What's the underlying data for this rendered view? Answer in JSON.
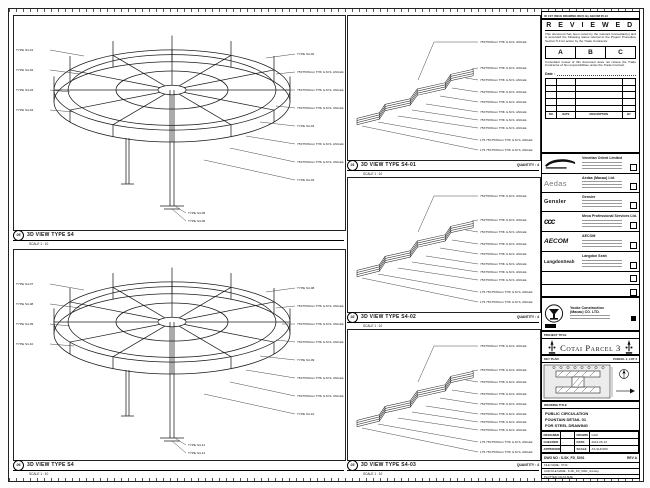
{
  "sheet": {
    "revision_strip": "00 1ST ISSUE DRAWING REV1 By AECOM 05.13",
    "stamp": {
      "title": "R E V I E W E D",
      "body1": "This document has been noted by the relevant Consultant(s) and is accorded the following status referral to the Project Procedure Section 5.4 for action by the Trade Contractor.",
      "grade_a": "A",
      "grade_b": "B",
      "grade_c": "C",
      "body2": "Consultant review of this document does not relieve the Trade Contractor of his responsibilities under the Trade Contract.",
      "date_label": "Date :",
      "th_no": "NO.",
      "th_date": "DATE",
      "th_desc": "DESCRIPTION",
      "th_by": "BY"
    },
    "consultants": {
      "venetian": "Venetian Orient Limited",
      "aedas_logo": "Aedas",
      "aedas": "Aedas (Macau) Ltd.",
      "gensler_logo": "Gensler",
      "gensler": "Gensler",
      "meca_logo": "ccc",
      "meca": "Meca Professional Services Ltd.",
      "aecom_logo": "AECOM",
      "aecom": "AECOM",
      "langdon_logo": "LangdonSeah",
      "langdon": "Langdon Seah"
    },
    "contractor": {
      "name1": "Yooke Construction",
      "name2": "(Macau) CO. LTD."
    },
    "project": {
      "band_label": "PROJECT TITLE",
      "title": "Cotai Parcel 3"
    },
    "key_plan": {
      "band_label": "KEY PLAN",
      "zone_label": "PARCEL 1, LOT 3"
    },
    "drawing_title": {
      "band_label": "DRAWING TITLE",
      "line1": "PUBLIC CIRCULATION",
      "line2": "FOUNTAIN DETAIL 01",
      "line3": "FOR STEEL DRAWING"
    },
    "info": {
      "designed_label": "DESIGNED",
      "designed": "-",
      "drawn_label": "DRAWN",
      "drawn": "CAD",
      "checked_label": "CHECKED",
      "checked": "-",
      "date_label": "DATE",
      "date": "2013-05-13",
      "approved_label": "APPROVED",
      "approved": "-",
      "scale_label": "SCALE",
      "scale": "AS SHOWN",
      "dwg_label": "DWG NO : S-SK_FD_S001",
      "rev_label": "REV  A",
      "file_name": "FILE NAME : 0710",
      "cad_file": "CAD FILE NAME : S-SK_FD_S001_S4.dwg",
      "plotted": "PLOTTED ON A3 SIZE"
    }
  },
  "panels": {
    "a": {
      "bubble": "05",
      "title": "3D VIEW TYPE S4",
      "scale": "SCALE 1 : 10",
      "left_labels": [
        "TYPE S4-01",
        "TYPE S4-02",
        "TYPE S4-03",
        "TYPE S4-04"
      ],
      "right_labels": [
        "TYPE S4-02",
        "75X75X6mm THK G.M.S. ANGLE",
        "75X75X6mm THK G.M.S. ANGLE",
        "75X75X6mm THK G.M.S. ANGLE",
        "TYPE S4-03",
        "75X75X6mm THK G.M.S. ANGLE",
        "75X75X6mm THK G.M.S. ANGLE",
        "TYPE S4-04"
      ],
      "bottom_labels": [
        "TYPE S4-05",
        "TYPE S4-06"
      ]
    },
    "b": {
      "bubble": "06",
      "title": "3D VIEW TYPE S4",
      "scale": "SCALE 1 : 10",
      "left_labels": [
        "TYPE S4-07",
        "TYPE S4-08",
        "TYPE S4-09",
        "TYPE S4-10"
      ],
      "right_labels": [
        "TYPE S4-08",
        "75X75X6mm THK G.M.S. ANGLE",
        "75X75X6mm THK G.M.S. ANGLE",
        "75X75X6mm THK G.M.S. ANGLE",
        "TYPE S4-09",
        "75X75X6mm THK G.M.S. ANGLE",
        "75X75X6mm THK G.M.S. ANGLE",
        "TYPE S4-10"
      ],
      "bottom_labels": [
        "TYPE S4-11",
        "TYPE S4-12"
      ]
    },
    "m1": {
      "bubble": "01",
      "title": "3D VIEW TYPE S4-01",
      "quantity": "QUANTITY : 4",
      "scale": "SCALE 1 : 10",
      "top_label": "75X75X6mm THK G.M.S. ANGLE",
      "right_labels": [
        "75X75X6mm THK G.M.S. ANGLE",
        "75X75X6mm THK G.M.S. ANGLE",
        "75X75X6mm THK G.M.S. ANGLE",
        "75X75X6mm THK G.M.S. ANGLE",
        "75X75X6mm THK G.M.S. ANGLE",
        "75X75X6mm THK G.M.S. ANGLE",
        "75X75X6mm THK G.M.S. ANGLE",
        "L75 75X75X6mm THK G.M.S. ANGLE",
        "L75 75X75X6mm THK G.M.S. ANGLE"
      ]
    },
    "m2": {
      "bubble": "02",
      "title": "3D VIEW TYPE S4-02",
      "quantity": "QUANTITY : 4",
      "scale": "SCALE 1 : 10",
      "top_label": "75X75X6mm THK G.M.S. ANGLE",
      "right_labels": [
        "75X75X6mm THK G.M.S. ANGLE",
        "75X75X6mm THK G.M.S. ANGLE",
        "75X75X6mm THK G.M.S. ANGLE",
        "75X75X6mm THK G.M.S. ANGLE",
        "75X75X6mm THK G.M.S. ANGLE",
        "75X75X6mm THK G.M.S. ANGLE",
        "75X75X6mm THK G.M.S. ANGLE",
        "L75 75X75X6mm THK G.M.S. ANGLE",
        "L75 75X75X6mm THK G.M.S. ANGLE"
      ]
    },
    "m3": {
      "bubble": "03",
      "title": "3D VIEW TYPE S4-03",
      "quantity": "QUANTITY : 4",
      "scale": "SCALE 1 : 10",
      "top_label": "75X75X6mm THK G.M.S. ANGLE",
      "right_labels": [
        "75X75X6mm THK G.M.S. ANGLE",
        "75X75X6mm THK G.M.S. ANGLE",
        "75X75X6mm THK G.M.S. ANGLE",
        "75X75X6mm THK G.M.S. ANGLE",
        "75X75X6mm THK G.M.S. ANGLE",
        "75X75X6mm THK G.M.S. ANGLE",
        "75X75X6mm THK G.M.S. ANGLE",
        "L75 75X75X6mm THK G.M.S. ANGLE",
        "L75 75X75X6mm THK G.M.S. ANGLE"
      ]
    }
  }
}
